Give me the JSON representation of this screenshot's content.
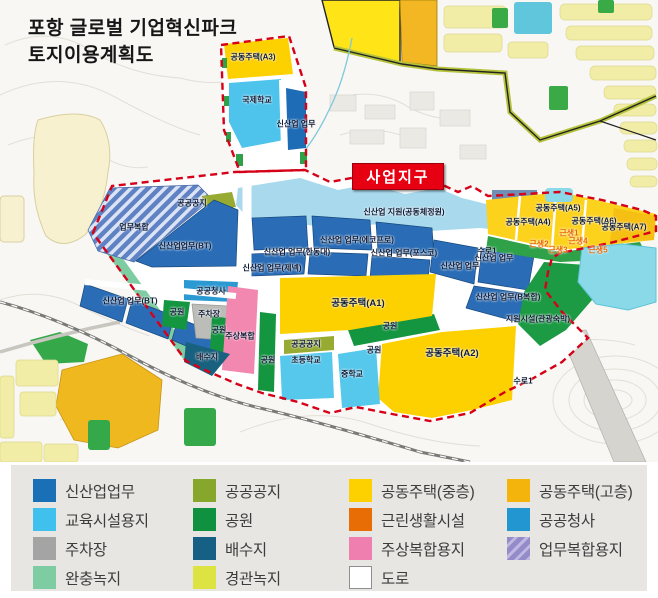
{
  "title": {
    "line1": "포항 글로벌 기업혁신파크",
    "line2": "토지이용계획도"
  },
  "badge": {
    "label": "사업지구",
    "bg": "#e60012",
    "text_color": "#ffffff"
  },
  "map": {
    "boundary_color": "#d60018",
    "labels": [
      {
        "t": "공동주택(A3)",
        "x": 253,
        "y": 57
      },
      {
        "t": "국제학교",
        "x": 257,
        "y": 100
      },
      {
        "t": "신산업 업무",
        "x": 296,
        "y": 124
      },
      {
        "t": "공공공지",
        "x": 192,
        "y": 203
      },
      {
        "t": "업무복합",
        "x": 134,
        "y": 227
      },
      {
        "t": "신산업업무(BT)",
        "x": 185,
        "y": 246
      },
      {
        "t": "신산업 지원(공동체정원)",
        "x": 404,
        "y": 212
      },
      {
        "t": "신산업 업무(에코프로)",
        "x": 357,
        "y": 240
      },
      {
        "t": "신산업 업무(한동대)",
        "x": 297,
        "y": 252
      },
      {
        "t": "신산업 업무(포스코)",
        "x": 404,
        "y": 253
      },
      {
        "t": "신산업 업무(제넥)",
        "x": 272,
        "y": 268
      },
      {
        "t": "신산업 업무",
        "x": 494,
        "y": 258
      },
      {
        "t": "신산업 업무",
        "x": 460,
        "y": 266
      },
      {
        "t": "신산업 업무(BT)",
        "x": 130,
        "y": 301
      },
      {
        "t": "공공청사",
        "x": 211,
        "y": 291
      },
      {
        "t": "공원",
        "x": 177,
        "y": 312
      },
      {
        "t": "주차장",
        "x": 209,
        "y": 314
      },
      {
        "t": "공원",
        "x": 219,
        "y": 330
      },
      {
        "t": "주상복합",
        "x": 240,
        "y": 336
      },
      {
        "t": "배수지",
        "x": 207,
        "y": 357
      },
      {
        "t": "공동주택(A1)",
        "x": 358,
        "y": 302,
        "s": 1
      },
      {
        "t": "공원",
        "x": 390,
        "y": 326
      },
      {
        "t": "공원",
        "x": 374,
        "y": 350
      },
      {
        "t": "공원",
        "x": 268,
        "y": 360
      },
      {
        "t": "공공공지",
        "x": 306,
        "y": 344
      },
      {
        "t": "초등학교",
        "x": 306,
        "y": 360
      },
      {
        "t": "중학교",
        "x": 352,
        "y": 374
      },
      {
        "t": "공동주택(A2)",
        "x": 452,
        "y": 352,
        "s": 1
      },
      {
        "t": "수로1",
        "x": 523,
        "y": 381
      },
      {
        "t": "신산업 업무(B복합)",
        "x": 508,
        "y": 297
      },
      {
        "t": "지원시설(관광숙박)",
        "x": 538,
        "y": 319
      },
      {
        "t": "공동주택(A4)",
        "x": 528,
        "y": 222
      },
      {
        "t": "공동주택(A5)",
        "x": 558,
        "y": 208
      },
      {
        "t": "공동주택(A6)",
        "x": 594,
        "y": 221
      },
      {
        "t": "공동주택(A7)",
        "x": 624,
        "y": 227
      },
      {
        "t": "근생1",
        "x": 569,
        "y": 233,
        "c": "orange"
      },
      {
        "t": "근생2",
        "x": 539,
        "y": 244,
        "c": "orange"
      },
      {
        "t": "근생4",
        "x": 578,
        "y": 241,
        "c": "orange"
      },
      {
        "t": "근생3",
        "x": 558,
        "y": 250,
        "c": "orange"
      },
      {
        "t": "근생5",
        "x": 598,
        "y": 250,
        "c": "orange"
      },
      {
        "t": "수로1",
        "x": 487,
        "y": 251
      }
    ]
  },
  "legend": {
    "columns": [
      [
        {
          "label": "신산업업무",
          "color": "#1a70b7"
        },
        {
          "label": "교육시설용지",
          "color": "#40c0ec"
        },
        {
          "label": "주차장",
          "color": "#a4a4a4"
        },
        {
          "label": "완충녹지",
          "color": "#7ecca2"
        }
      ],
      [
        {
          "label": "공공공지",
          "color": "#87a62c"
        },
        {
          "label": "공원",
          "color": "#0f9140"
        },
        {
          "label": "배수지",
          "color": "#166086"
        },
        {
          "label": "경관녹지",
          "color": "#dde340"
        }
      ],
      [
        {
          "label": "공동주택(중층)",
          "color": "#fdd000"
        },
        {
          "label": "근린생활시설",
          "color": "#e96d05"
        },
        {
          "label": "주상복합용지",
          "color": "#ef7fae"
        },
        {
          "label": "도로",
          "color": "#ffffff",
          "border": true
        }
      ],
      [
        {
          "label": "공동주택(고층)",
          "color": "#f4b40b"
        },
        {
          "label": "공공청사",
          "color": "#2196d0"
        },
        {
          "label": "업무복합용지",
          "color": "#9389ca",
          "striped": true
        }
      ]
    ]
  }
}
